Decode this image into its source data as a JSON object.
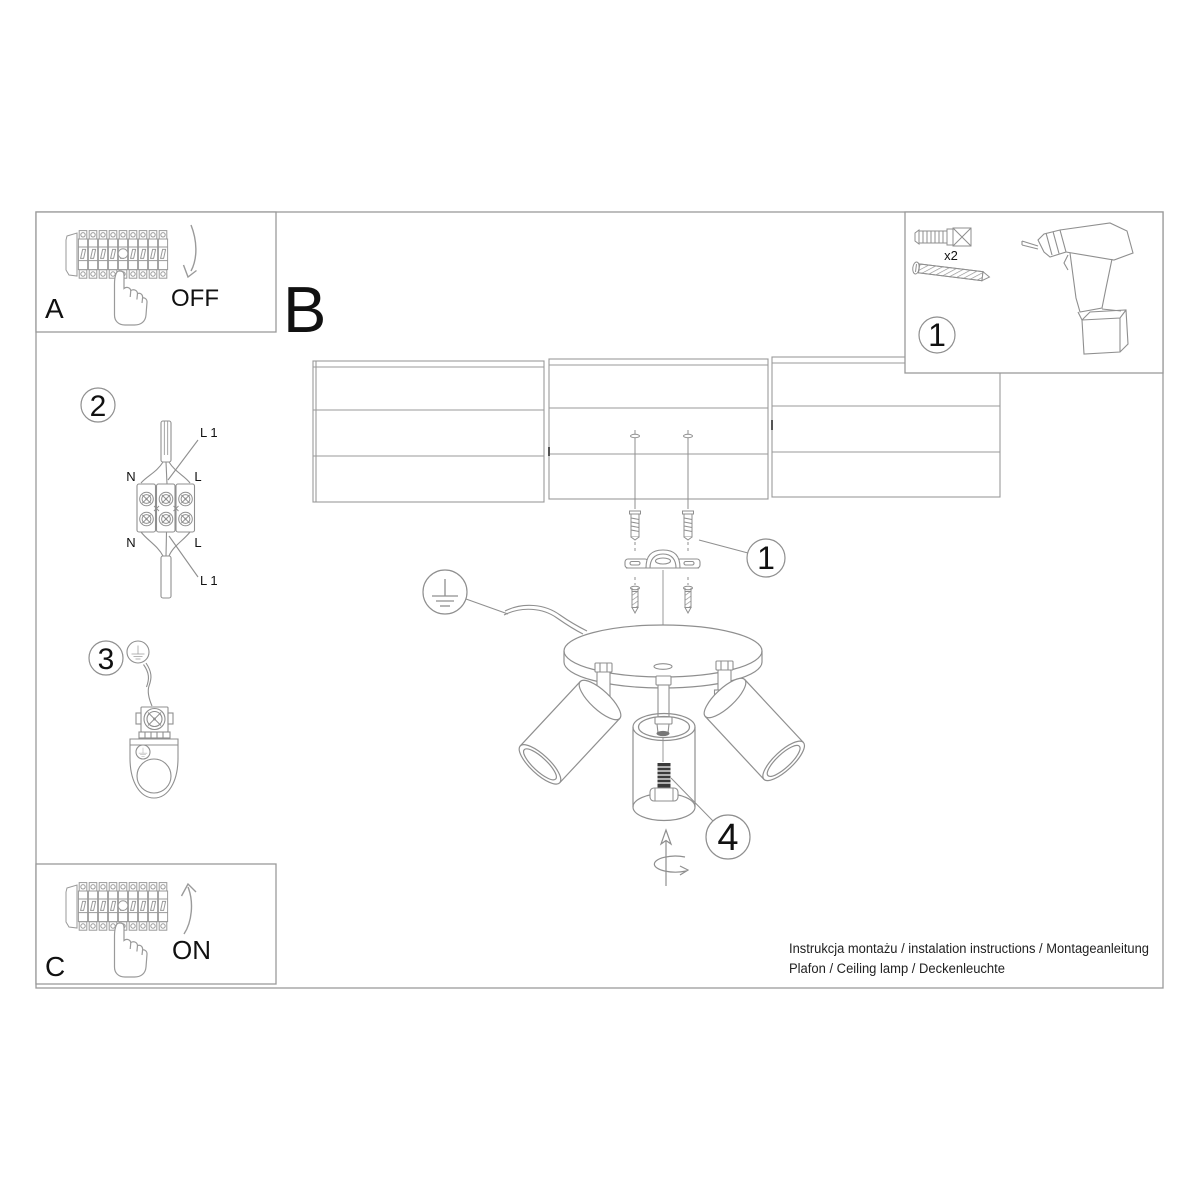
{
  "colors": {
    "line": "#8f8f8f",
    "line_dark": "#555555",
    "text": "#111111",
    "bg": "#ffffff"
  },
  "sections": {
    "a": {
      "label": "A",
      "state": "OFF"
    },
    "b": {
      "label": "B"
    },
    "c": {
      "label": "C",
      "state": "ON"
    }
  },
  "badges": {
    "tools": "1",
    "wiring": "2",
    "ground": "3",
    "bracket": "1",
    "adjust": "4"
  },
  "tools": {
    "anchor_qty": "x2"
  },
  "wiring": {
    "top_l1": "L 1",
    "top_n": "N",
    "top_l": "L",
    "bottom_n": "N",
    "bottom_l": "L",
    "bottom_l1": "L 1"
  },
  "footer": {
    "line1": "Instrukcja montażu / instalation instructions / Montageanleitung",
    "line2": "Plafon / Ceiling lamp / Deckenleuchte"
  }
}
